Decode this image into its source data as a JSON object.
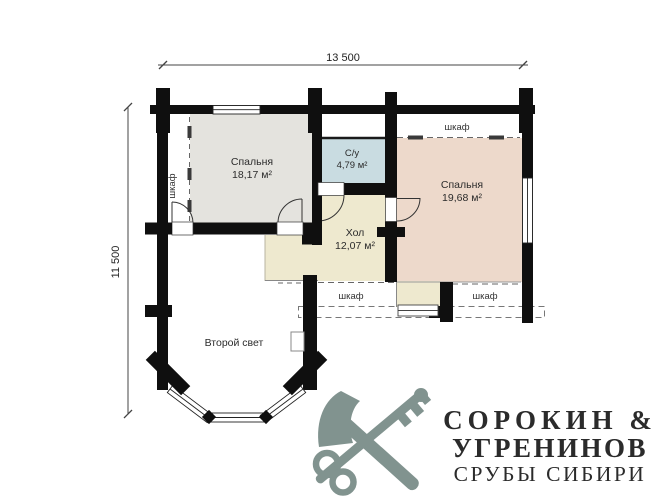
{
  "plan": {
    "dim_width": "13 500",
    "dim_height": "11 500",
    "rooms": [
      {
        "name": "Спальня",
        "area": "18,17 м²",
        "color": "#e4e3de"
      },
      {
        "name": "С/у",
        "area": "4,79 м²",
        "color": "#c9dce1"
      },
      {
        "name": "Спальня",
        "area": "19,68 м²",
        "color": "#edd9cb"
      },
      {
        "name": "Хол",
        "area": "12,07 м²",
        "color": "#eee9cf"
      },
      {
        "name": "Второй свет"
      }
    ],
    "closet_label_left": "шкаф",
    "closet_label_top_right": "шкаф",
    "closet_label_bottom_center": "шкаф",
    "closet_label_bottom_right": "шкаф"
  },
  "logo": {
    "line1": "СОРОКИН &",
    "line2": "УГРЕНИНОВ",
    "line3": "СРУБЫ СИБИРИ",
    "color": "#81938f"
  },
  "colors": {
    "wall": "#0f0f0f",
    "dimension_line": "#444444"
  }
}
